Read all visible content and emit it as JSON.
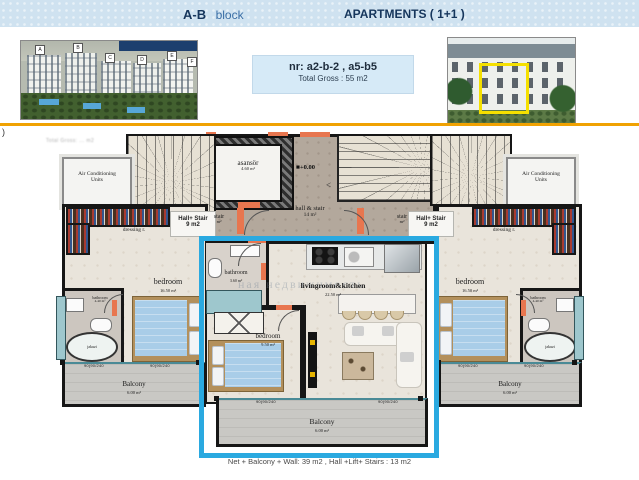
{
  "header": {
    "block_name": "A-B",
    "block_word": "block",
    "title": "APARTMENTS  ( 1+1 )"
  },
  "info_box": {
    "nr": "nr:  a2-b-2  , a5-b5",
    "gross": "Total Gross : 55 m2"
  },
  "photos": {
    "site_labels": [
      "A",
      "B",
      "C",
      "D",
      "E",
      "F"
    ]
  },
  "margin_mark": ")",
  "smudge": "Total Gross: ... m2",
  "plan": {
    "elevator": {
      "label": "asansör",
      "area": "4.60 m²"
    },
    "level": "+0.00",
    "hall": {
      "label": "hall & stair",
      "area": "14 m²"
    },
    "stair_small": {
      "label": "stair",
      "area": "m²"
    },
    "hall_stair": {
      "line1": "Hall+ Stair",
      "line2": "9 m2"
    },
    "ac": "Air Conditioning Units",
    "dressing": "dressing r.",
    "side_bedroom": {
      "label": "bedroom",
      "area": "16.50 m²"
    },
    "side_bathroom": {
      "label": "bathroom",
      "area": "4.40 m²"
    },
    "jakuzi": "jakuzi",
    "balcony": {
      "label": "Balcony",
      "area": "6.00 m²"
    },
    "unit_bathroom": {
      "label": "bathroom",
      "area": "3.60 m²"
    },
    "unit_living": {
      "label": "livingroom&kitchen",
      "area": "22.50 m²"
    },
    "unit_bedroom": {
      "label": "bedroom",
      "area": "9.50 m²"
    },
    "window_mark": "90(90/240",
    "arrow": "<",
    "watermark": "ная недвижимость"
  },
  "footer": {
    "note": "Net + Balcony + Wall: 39 m2  , Hall +Lift+ Stairs  : 13 m2"
  },
  "colors": {
    "highlight_blue": "#2aa9e0",
    "accent_orange": "#e8764f",
    "rule_gold": "#f0a202",
    "header_navy": "#16365c"
  }
}
